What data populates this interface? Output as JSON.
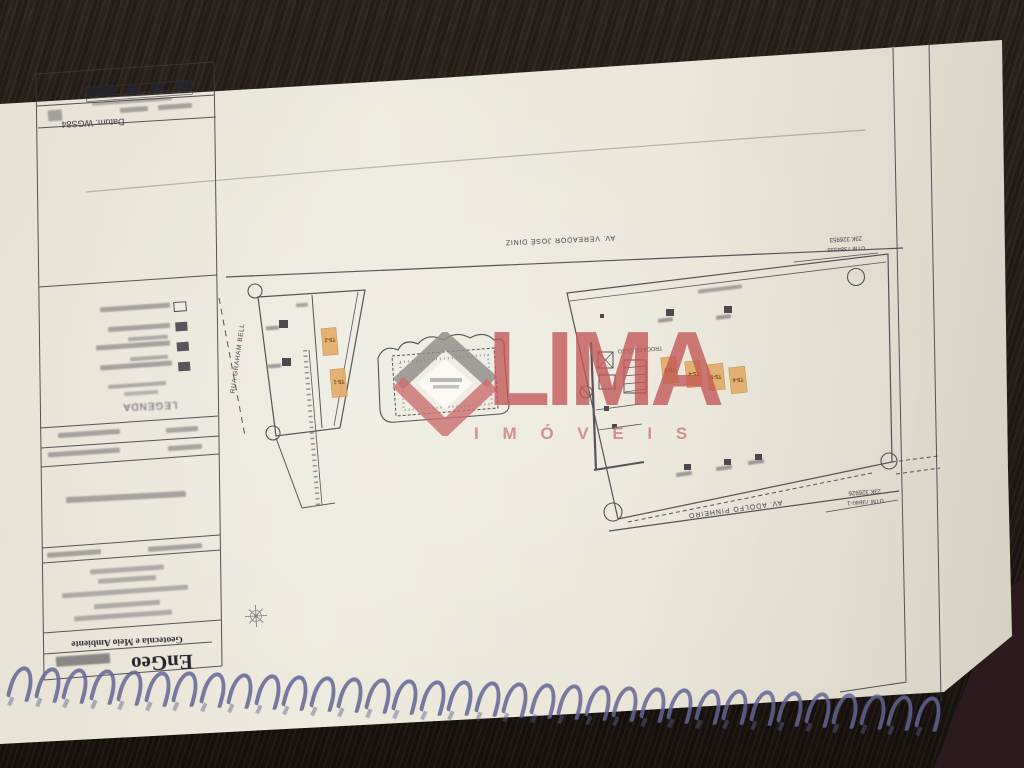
{
  "watermark": {
    "brand": "LIMA",
    "subtitle": "I M Ó V E I S",
    "accent": "#c15654"
  },
  "title_block": {
    "datum": "Datum: WGS84",
    "legend_title": "LEGENDA",
    "company": "EnGeo",
    "company_tagline": "Geotecnia e Meio Ambiente"
  },
  "streets": {
    "top": "AV. VEREADOR JOSÉ DINIZ",
    "left": "RUA GRAHAM BELL",
    "bottom": "AV. ADOLFO PINHEIRO"
  },
  "survey_marks": {
    "top_right_line1": "UTM 7384533",
    "top_right_line2": "23K 326953",
    "bottom_right_line1": "UTM 73840-1",
    "bottom_right_line2": "23K 326926"
  },
  "plan_labels": {
    "central_area": "TROCA DE ÓLEO",
    "ts_left_top": "TS-2",
    "ts_left_bottom": "TS-1",
    "ts_row": [
      "TS-3",
      "TS-4",
      "TS-5",
      "TS-6"
    ],
    "highlight_color": "#e2a055"
  }
}
